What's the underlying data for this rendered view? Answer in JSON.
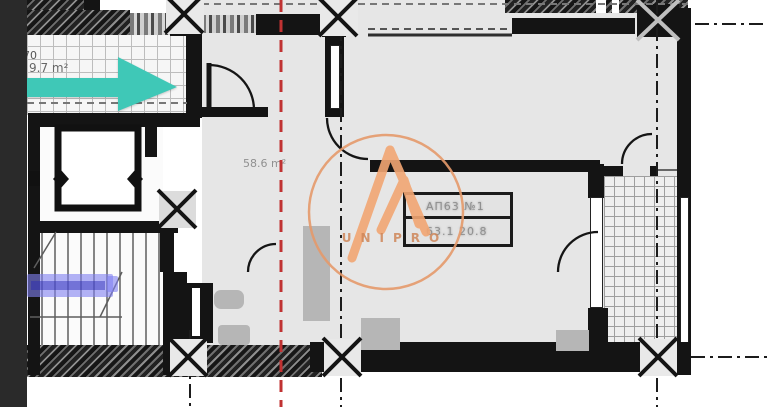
{
  "plan": {
    "terrace": {
      "number": "70",
      "area": "9.7 m²"
    },
    "hall": {
      "area": "58.6 m²"
    },
    "apartment_tag": {
      "line1": "АП63 №1",
      "line2": "63.1  20.8"
    },
    "watermark": {
      "text": "UNIPRO"
    },
    "colors": {
      "arrow_teal": "#3fc8b7",
      "axis_red": "#c03232",
      "wall_black": "#141414",
      "floor_gray": "#e6e6e6",
      "watermark_orange": "#eda36f",
      "highlight_purple": "#8080f2",
      "sidebar_dark": "#2a2a2a",
      "furniture_gray": "#b6b6b6"
    }
  }
}
